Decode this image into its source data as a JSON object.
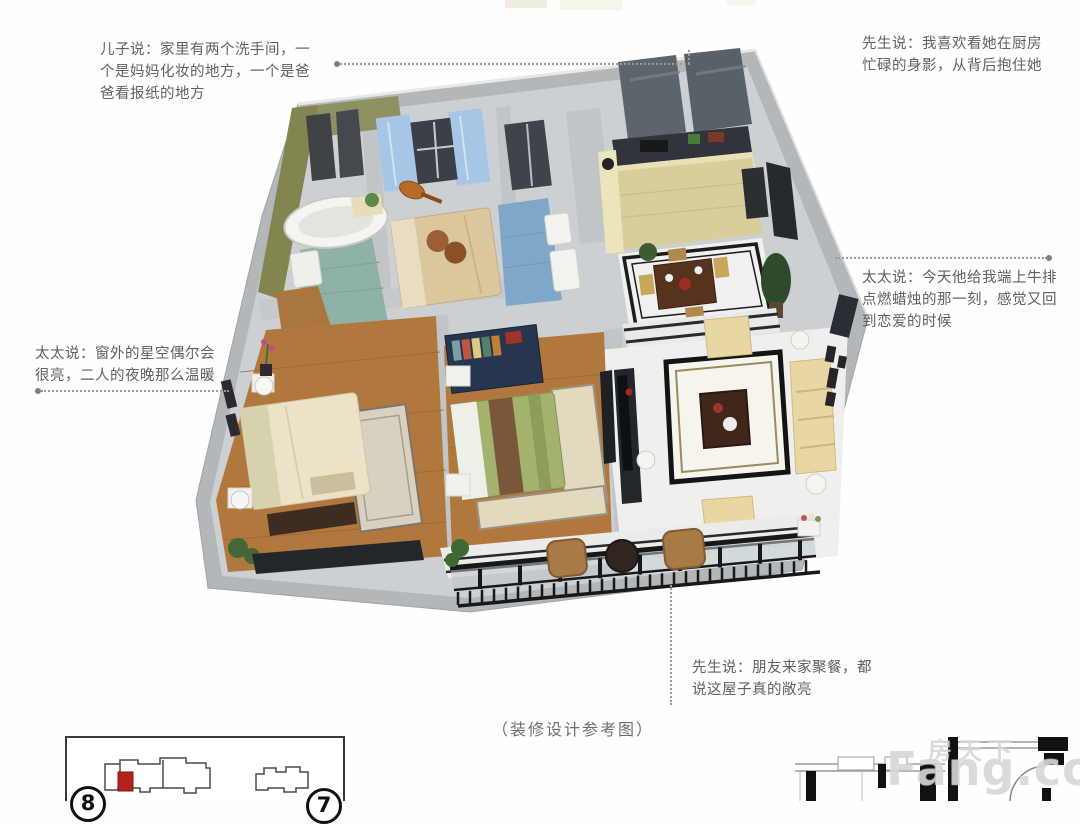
{
  "annotations": {
    "son": "儿子说：家里有两个洗手间，一个是妈妈化妆的地方，一个是爸爸看报纸的地方",
    "husband_kitchen": "先生说：我喜欢看她在厨房忙碌的身影，从背后抱住她",
    "wife_steak": "太太说：今天他给我端上牛排点燃蜡烛的那一刻，感觉又回到恋爱的时候",
    "wife_stars": "太太说：窗外的星空偶尔会很亮，二人的夜晚那么温暖",
    "husband_guests": "先生说：朋友来家聚餐，都说这屋子真的敞亮"
  },
  "caption": "（装修设计参考图）",
  "inset": {
    "left_unit_number": "8",
    "right_unit_number": "7"
  },
  "watermark": {
    "cn": "房天下",
    "en": "Fang.com"
  },
  "colors": {
    "unit_highlight_red": "#b3221d",
    "wall_gray": "#b6b9bb",
    "wood_floor": "#b1783e",
    "curtain_blue": "#a6c6e6",
    "sofa_cream": "#e8d7a2",
    "bath_tile_green": "#8e9060",
    "bath_tile_teal": "#8fb2a6",
    "kitchen_tile": "#d8ce9c",
    "watermark_gray": "#c9c9c9"
  }
}
